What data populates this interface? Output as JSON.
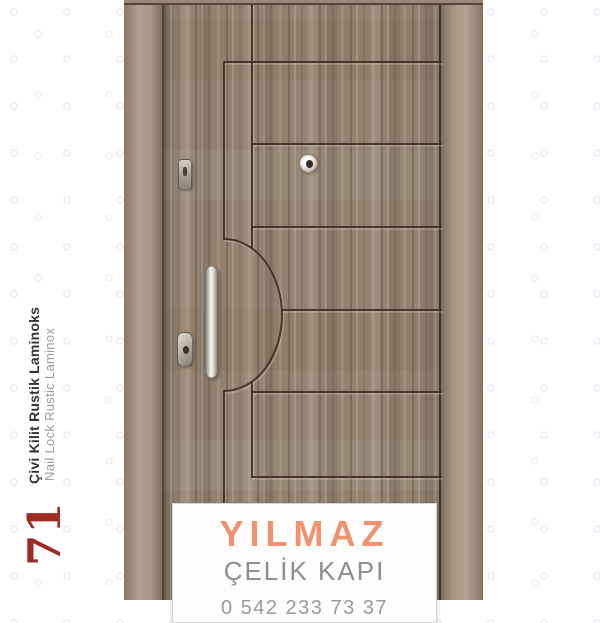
{
  "sidebar": {
    "product_title_tr": "Çivi Kilit Rustik Laminoks",
    "product_title_en": "Nail Lock Rustic Laminox",
    "product_number": "71",
    "number_color": "#9e2c24"
  },
  "door": {
    "description": "steel door with rustic wood laminate, horizontal grooves and semicircular arc relief",
    "hardware": [
      "doorbell-button",
      "peephole",
      "pull-handle",
      "lock-cylinder"
    ],
    "colors": {
      "frame": "#a3907e",
      "wood_base": "#93826f",
      "wood_dark": "#6e5c4e",
      "wood_light": "#b4a492",
      "groove": "#402e1f"
    }
  },
  "label": {
    "brand": "YILMAZ",
    "brand_color": "#f0926f",
    "subtitle": "ÇELİK KAPI",
    "phone_partial": "0 542 233 73 37"
  }
}
